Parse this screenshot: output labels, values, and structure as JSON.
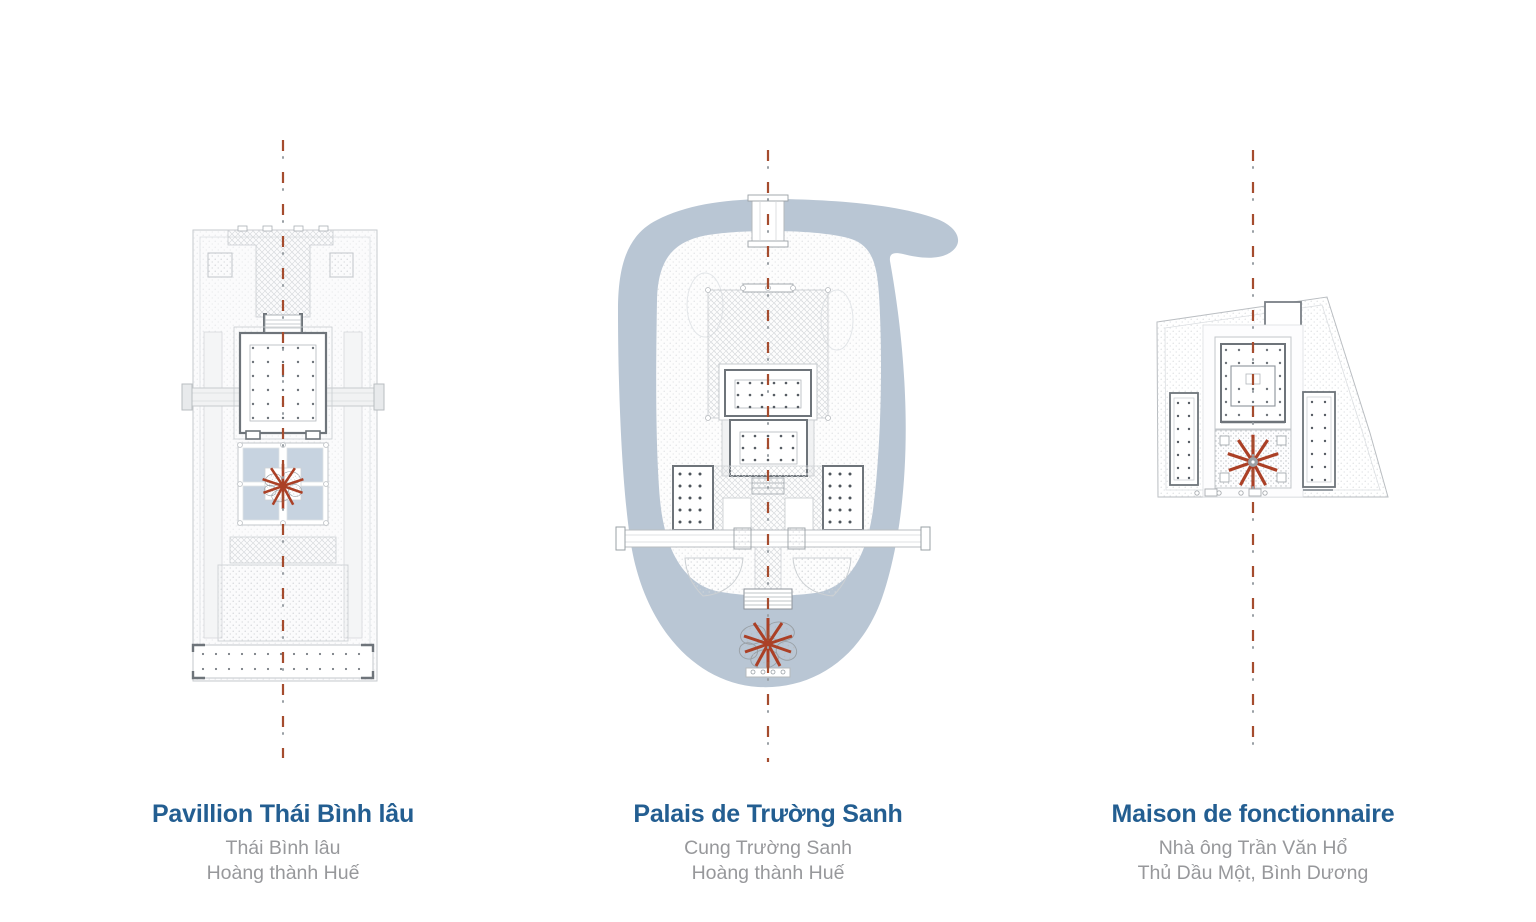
{
  "page": {
    "background": "#ffffff",
    "description_labels": {
      "drawing_type": "comparative site plans with central axis"
    }
  },
  "colors": {
    "title_blue": "#235e91",
    "subtitle_gray": "#97989b",
    "axis_terracotta": "#a54c2e",
    "starburst_red": "#ab4026",
    "water_blue": "#b9c6d4",
    "pond_blue": "#c7d3e0",
    "wall_dark": "#6e747a",
    "outline_gray": "#c3c7cb"
  },
  "figures": [
    {
      "id": "thai-binh-lau",
      "title": "Pavillion Thái Bình lâu",
      "subtitle1": "Thái Bình lâu",
      "subtitle2": "Hoàng thành Huế"
    },
    {
      "id": "truong-sanh",
      "title": "Palais de Trường Sanh",
      "subtitle1": "Cung Trường Sanh",
      "subtitle2": "Hoàng thành Huế"
    },
    {
      "id": "maison-fonctionnaire",
      "title": "Maison de fonctionnaire",
      "subtitle1": "Nhà ông Trần Văn Hổ",
      "subtitle2": "Thủ Dầu Một, Bình Dương"
    }
  ]
}
